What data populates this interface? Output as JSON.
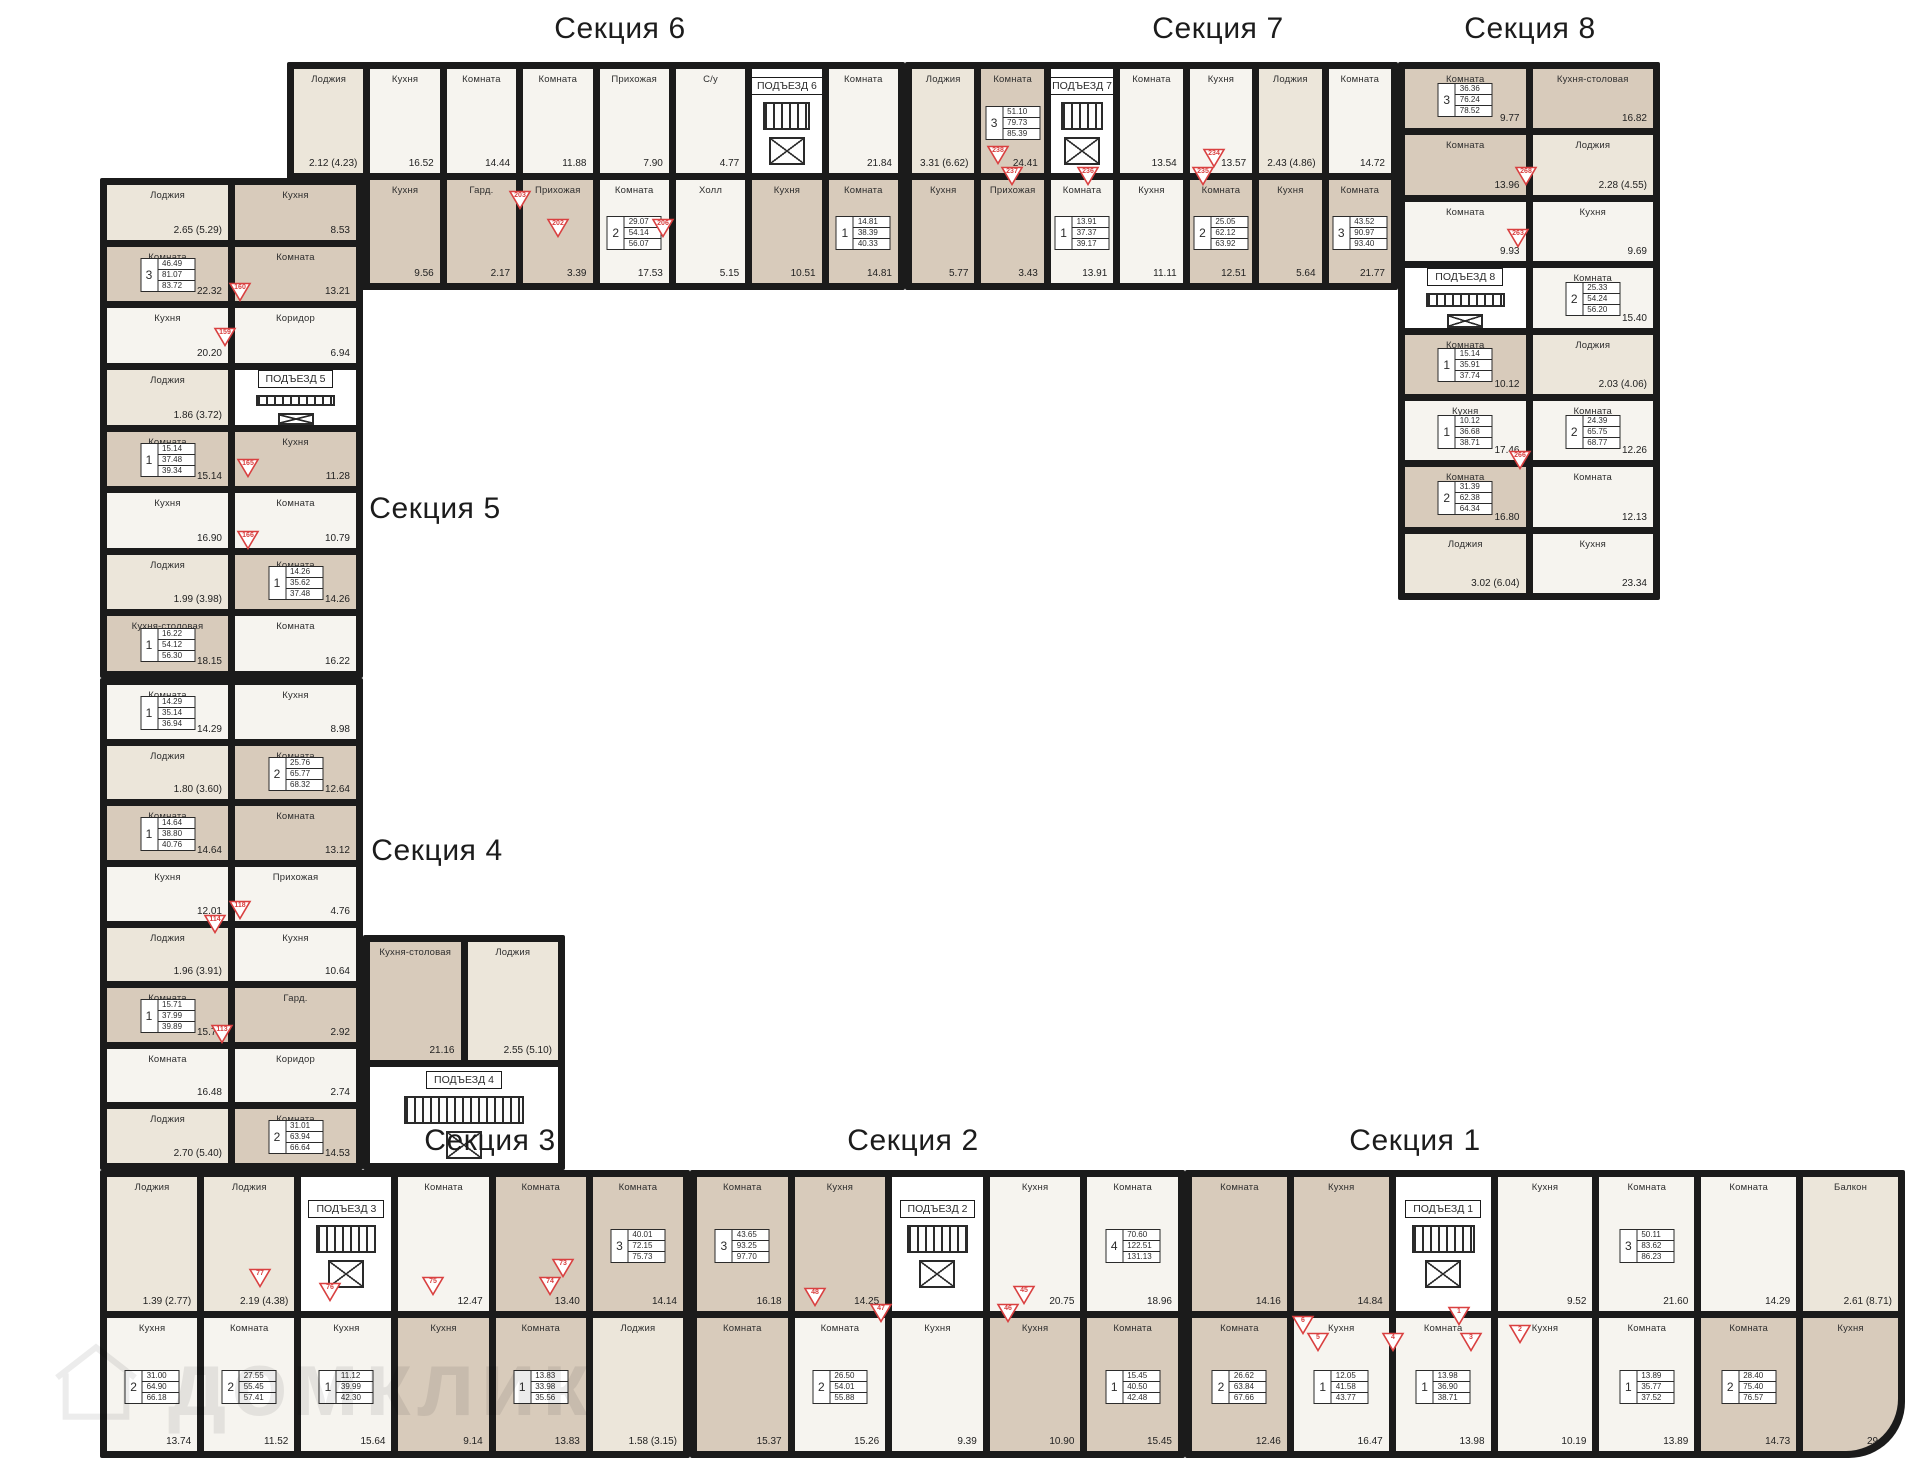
{
  "palette": {
    "wall": "#1b1b1b",
    "beige": "#d8cbbb",
    "white_room": "#f6f4ef",
    "loggia": "#ece6da",
    "accent_red": "#d94040"
  },
  "watermark": {
    "text": "домклик",
    "icon": "house-icon"
  },
  "sections": [
    {
      "id": "1",
      "title": "Секция 1",
      "tx": 1415,
      "ty": 1124
    },
    {
      "id": "2",
      "title": "Секция 2",
      "tx": 913,
      "ty": 1124
    },
    {
      "id": "3",
      "title": "Секция 3",
      "tx": 490,
      "ty": 1124
    },
    {
      "id": "4",
      "title": "Секция 4",
      "tx": 437,
      "ty": 834
    },
    {
      "id": "5",
      "title": "Секция 5",
      "tx": 435,
      "ty": 492
    },
    {
      "id": "6",
      "title": "Секция 6",
      "tx": 620,
      "ty": 12
    },
    {
      "id": "7",
      "title": "Секция 7",
      "tx": 1218,
      "ty": 12
    },
    {
      "id": "8",
      "title": "Секция 8",
      "tx": 1530,
      "ty": 12
    }
  ],
  "badges": [
    {
      "n": "203",
      "x": 520,
      "y": 200
    },
    {
      "n": "202",
      "x": 558,
      "y": 228
    },
    {
      "n": "206",
      "x": 663,
      "y": 228
    },
    {
      "n": "238",
      "x": 998,
      "y": 155
    },
    {
      "n": "237",
      "x": 1012,
      "y": 176
    },
    {
      "n": "236",
      "x": 1088,
      "y": 176
    },
    {
      "n": "235",
      "x": 1203,
      "y": 176
    },
    {
      "n": "234",
      "x": 1214,
      "y": 158
    },
    {
      "n": "268",
      "x": 1526,
      "y": 176
    },
    {
      "n": "263",
      "x": 1518,
      "y": 238
    },
    {
      "n": "266",
      "x": 1520,
      "y": 460
    },
    {
      "n": "160",
      "x": 240,
      "y": 292
    },
    {
      "n": "159",
      "x": 225,
      "y": 337
    },
    {
      "n": "165",
      "x": 248,
      "y": 468
    },
    {
      "n": "166",
      "x": 248,
      "y": 540
    },
    {
      "n": "118",
      "x": 240,
      "y": 910
    },
    {
      "n": "114",
      "x": 215,
      "y": 924
    },
    {
      "n": "113",
      "x": 222,
      "y": 1034
    },
    {
      "n": "77",
      "x": 260,
      "y": 1278
    },
    {
      "n": "76",
      "x": 330,
      "y": 1292
    },
    {
      "n": "75",
      "x": 433,
      "y": 1286
    },
    {
      "n": "74",
      "x": 550,
      "y": 1286
    },
    {
      "n": "73",
      "x": 563,
      "y": 1268
    },
    {
      "n": "48",
      "x": 815,
      "y": 1297
    },
    {
      "n": "47",
      "x": 881,
      "y": 1313
    },
    {
      "n": "46",
      "x": 1008,
      "y": 1313
    },
    {
      "n": "45",
      "x": 1024,
      "y": 1295
    },
    {
      "n": "6",
      "x": 1303,
      "y": 1325
    },
    {
      "n": "5",
      "x": 1318,
      "y": 1342
    },
    {
      "n": "4",
      "x": 1393,
      "y": 1342
    },
    {
      "n": "3",
      "x": 1471,
      "y": 1342
    },
    {
      "n": "2",
      "x": 1520,
      "y": 1334
    },
    {
      "n": "1",
      "x": 1459,
      "y": 1316
    }
  ],
  "wings": [
    {
      "name": "section6-band",
      "x": 287,
      "y": 62,
      "w": 618,
      "h": 228,
      "cols": 8,
      "cells": [
        {
          "r": "Лоджия",
          "a": "2.12 (4.23)",
          "v": "l"
        },
        {
          "r": "Кухня",
          "a": "16.52",
          "v": "w"
        },
        {
          "r": "Комната",
          "a": "14.44",
          "v": "w"
        },
        {
          "r": "Комната",
          "a": "11.88",
          "v": "w"
        },
        {
          "r": "Прихожая",
          "a": "7.90",
          "v": "w"
        },
        {
          "r": "С/у",
          "a": "4.77",
          "v": "w"
        },
        {
          "v": "core",
          "ent": "ПОДЪЕЗД 6"
        },
        {
          "r": "Комната",
          "a": "21.84",
          "v": "w"
        },
        {
          "r": "Комната",
          "a": "12.45",
          "v": "b",
          "apt": {
            "n": "3",
            "v1": "38.77",
            "v2": "84.77",
            "v3": "89.03"
          }
        },
        {
          "r": "Кухня",
          "a": "9.56",
          "v": "b"
        },
        {
          "r": "Гард.",
          "a": "2.17",
          "v": "b"
        },
        {
          "r": "Прихожая",
          "a": "3.39",
          "v": "b"
        },
        {
          "r": "Комната",
          "a": "17.53",
          "v": "w",
          "apt": {
            "n": "2",
            "v1": "29.07",
            "v2": "54.14",
            "v3": "56.07"
          }
        },
        {
          "r": "Холл",
          "a": "5.15",
          "v": "w"
        },
        {
          "r": "Кухня",
          "a": "10.51",
          "v": "b"
        },
        {
          "r": "Комната",
          "a": "14.81",
          "v": "b",
          "apt": {
            "n": "1",
            "v1": "14.81",
            "v2": "38.39",
            "v3": "40.33"
          }
        }
      ]
    },
    {
      "name": "section7-band",
      "x": 905,
      "y": 62,
      "w": 493,
      "h": 228,
      "cols": 7,
      "cells": [
        {
          "r": "Лоджия",
          "a": "3.31 (6.62)",
          "v": "l"
        },
        {
          "r": "Комната",
          "a": "24.41",
          "v": "b",
          "apt": {
            "n": "3",
            "v1": "51.10",
            "v2": "79.73",
            "v3": "85.39"
          }
        },
        {
          "v": "core",
          "ent": "ПОДЪЕЗД 7"
        },
        {
          "r": "Комната",
          "a": "13.54",
          "v": "w"
        },
        {
          "r": "Кухня",
          "a": "13.57",
          "v": "w"
        },
        {
          "r": "Лоджия",
          "a": "2.43 (4.86)",
          "v": "l"
        },
        {
          "r": "Комната",
          "a": "14.72",
          "v": "w"
        },
        {
          "r": "Кухня",
          "a": "5.77",
          "v": "b"
        },
        {
          "r": "Прихожая",
          "a": "3.43",
          "v": "b"
        },
        {
          "r": "Комната",
          "a": "13.91",
          "v": "w",
          "apt": {
            "n": "1",
            "v1": "13.91",
            "v2": "37.37",
            "v3": "39.17"
          }
        },
        {
          "r": "Кухня",
          "a": "11.11",
          "v": "w"
        },
        {
          "r": "Комната",
          "a": "12.51",
          "v": "b",
          "apt": {
            "n": "2",
            "v1": "25.05",
            "v2": "62.12",
            "v3": "63.92"
          }
        },
        {
          "r": "Кухня",
          "a": "5.64",
          "v": "b"
        },
        {
          "r": "Комната",
          "a": "21.77",
          "v": "b",
          "apt": {
            "n": "3",
            "v1": "43.52",
            "v2": "90.97",
            "v3": "93.40"
          }
        }
      ]
    },
    {
      "name": "section8-wing",
      "x": 1398,
      "y": 62,
      "w": 262,
      "h": 538,
      "cols": 2,
      "cells": [
        {
          "r": "Комната",
          "a": "9.77",
          "v": "b",
          "apt": {
            "n": "3",
            "v1": "36.36",
            "v2": "76.24",
            "v3": "78.52"
          }
        },
        {
          "r": "Кухня-столовая",
          "a": "16.82",
          "v": "b"
        },
        {
          "r": "Комната",
          "a": "13.96",
          "v": "b"
        },
        {
          "r": "Лоджия",
          "a": "2.28 (4.55)",
          "v": "l"
        },
        {
          "r": "Комната",
          "a": "9.93",
          "v": "w"
        },
        {
          "r": "Кухня",
          "a": "9.69",
          "v": "w"
        },
        {
          "v": "core",
          "ent": "ПОДЪЕЗД 8"
        },
        {
          "r": "Комната",
          "a": "15.40",
          "v": "w",
          "apt": {
            "n": "2",
            "v1": "25.33",
            "v2": "54.24",
            "v3": "56.20"
          }
        },
        {
          "r": "Комната",
          "a": "10.12",
          "v": "b",
          "apt": {
            "n": "1",
            "v1": "15.14",
            "v2": "35.91",
            "v3": "37.74"
          }
        },
        {
          "r": "Лоджия",
          "a": "2.03 (4.06)",
          "v": "l"
        },
        {
          "r": "Кухня",
          "a": "17.46",
          "v": "w",
          "apt": {
            "n": "1",
            "v1": "10.12",
            "v2": "36.68",
            "v3": "38.71"
          }
        },
        {
          "r": "Комната",
          "a": "12.26",
          "v": "w",
          "apt": {
            "n": "2",
            "v1": "24.39",
            "v2": "65.75",
            "v3": "68.77"
          }
        },
        {
          "r": "Комната",
          "a": "16.80",
          "v": "b",
          "apt": {
            "n": "2",
            "v1": "31.39",
            "v2": "62.38",
            "v3": "64.34"
          }
        },
        {
          "r": "Комната",
          "a": "12.13",
          "v": "w"
        },
        {
          "r": "Лоджия",
          "a": "3.02 (6.04)",
          "v": "l"
        },
        {
          "r": "Кухня",
          "a": "23.34",
          "v": "w"
        }
      ]
    },
    {
      "name": "section5-wing",
      "x": 100,
      "y": 178,
      "w": 263,
      "h": 500,
      "cols": 2,
      "cells": [
        {
          "r": "Лоджия",
          "a": "2.65 (5.29)",
          "v": "l"
        },
        {
          "r": "Кухня",
          "a": "8.53",
          "v": "b"
        },
        {
          "r": "Комната",
          "a": "22.32",
          "v": "b",
          "apt": {
            "n": "3",
            "v1": "46.49",
            "v2": "81.07",
            "v3": "83.72"
          }
        },
        {
          "r": "Комната",
          "a": "13.21",
          "v": "b"
        },
        {
          "r": "Кухня",
          "a": "20.20",
          "v": "w"
        },
        {
          "r": "Коридор",
          "a": "6.94",
          "v": "w"
        },
        {
          "r": "Лоджия",
          "a": "1.86 (3.72)",
          "v": "l"
        },
        {
          "v": "core",
          "ent": "ПОДЪЕЗД 5"
        },
        {
          "r": "Комната",
          "a": "15.14",
          "v": "b",
          "apt": {
            "n": "1",
            "v1": "15.14",
            "v2": "37.48",
            "v3": "39.34"
          }
        },
        {
          "r": "Кухня",
          "a": "11.28",
          "v": "b"
        },
        {
          "r": "Кухня",
          "a": "16.90",
          "v": "w"
        },
        {
          "r": "Комната",
          "a": "10.79",
          "v": "w"
        },
        {
          "r": "Лоджия",
          "a": "1.99 (3.98)",
          "v": "l"
        },
        {
          "r": "Комната",
          "a": "14.26",
          "v": "b",
          "apt": {
            "n": "1",
            "v1": "14.26",
            "v2": "35.62",
            "v3": "37.48"
          }
        },
        {
          "r": "Кухня-столовая",
          "a": "18.15",
          "v": "b",
          "apt": {
            "n": "1",
            "v1": "16.22",
            "v2": "54.12",
            "v3": "56.30"
          }
        },
        {
          "r": "Комната",
          "a": "16.22",
          "v": "w"
        }
      ]
    },
    {
      "name": "section4-wing",
      "x": 100,
      "y": 678,
      "w": 263,
      "h": 492,
      "cols": 2,
      "cells": [
        {
          "r": "Комната",
          "a": "14.29",
          "v": "w",
          "apt": {
            "n": "1",
            "v1": "14.29",
            "v2": "35.14",
            "v3": "36.94"
          }
        },
        {
          "r": "Кухня",
          "a": "8.98",
          "v": "w"
        },
        {
          "r": "Лоджия",
          "a": "1.80 (3.60)",
          "v": "l"
        },
        {
          "r": "Комната",
          "a": "12.64",
          "v": "b",
          "apt": {
            "n": "2",
            "v1": "25.76",
            "v2": "65.77",
            "v3": "68.32"
          }
        },
        {
          "r": "Комната",
          "a": "14.64",
          "v": "b",
          "apt": {
            "n": "1",
            "v1": "14.64",
            "v2": "38.80",
            "v3": "40.76"
          }
        },
        {
          "r": "Комната",
          "a": "13.12",
          "v": "b"
        },
        {
          "r": "Кухня",
          "a": "12.01",
          "v": "w"
        },
        {
          "r": "Прихожая",
          "a": "4.76",
          "v": "w"
        },
        {
          "r": "Лоджия",
          "a": "1.96 (3.91)",
          "v": "l"
        },
        {
          "r": "Кухня",
          "a": "10.64",
          "v": "w"
        },
        {
          "r": "Комната",
          "a": "15.71",
          "v": "b",
          "apt": {
            "n": "1",
            "v1": "15.71",
            "v2": "37.99",
            "v3": "39.89"
          }
        },
        {
          "r": "Гард.",
          "a": "2.92",
          "v": "b"
        },
        {
          "r": "Комната",
          "a": "16.48",
          "v": "w"
        },
        {
          "r": "Коридор",
          "a": "2.74",
          "v": "w"
        },
        {
          "r": "Лоджия",
          "a": "2.70 (5.40)",
          "v": "l"
        },
        {
          "r": "Комната",
          "a": "14.53",
          "v": "b",
          "apt": {
            "n": "2",
            "v1": "31.01",
            "v2": "63.94",
            "v3": "66.64"
          }
        }
      ]
    },
    {
      "name": "section4-inner-block",
      "x": 363,
      "y": 935,
      "w": 202,
      "h": 235,
      "cols": 2,
      "rowsTpl": "118px 1fr",
      "cells": [
        {
          "r": "Кухня-столовая",
          "a": "21.16",
          "v": "b"
        },
        {
          "r": "Лоджия",
          "a": "2.55 (5.10)",
          "v": "l"
        },
        {
          "v": "core",
          "ent": "ПОДЪЕЗД 4",
          "colspan": 2
        }
      ]
    },
    {
      "name": "section3-band",
      "x": 100,
      "y": 1170,
      "w": 590,
      "h": 288,
      "cols": 6,
      "cells": [
        {
          "r": "Лоджия",
          "a": "1.39 (2.77)",
          "v": "l"
        },
        {
          "r": "Лоджия",
          "a": "2.19 (4.38)",
          "v": "l"
        },
        {
          "v": "core",
          "ent": "ПОДЪЕЗД 3"
        },
        {
          "r": "Комната",
          "a": "12.47",
          "v": "w"
        },
        {
          "r": "Комната",
          "a": "13.40",
          "v": "b"
        },
        {
          "r": "Комната",
          "a": "14.14",
          "v": "b",
          "apt": {
            "n": "3",
            "v1": "40.01",
            "v2": "72.15",
            "v3": "75.73"
          }
        },
        {
          "r": "Кухня",
          "a": "13.74",
          "v": "w",
          "apt": {
            "n": "2",
            "v1": "31.00",
            "v2": "64.90",
            "v3": "66.18"
          }
        },
        {
          "r": "Комната",
          "a": "11.52",
          "v": "w",
          "apt": {
            "n": "2",
            "v1": "27.55",
            "v2": "55.45",
            "v3": "57.41"
          }
        },
        {
          "r": "Кухня",
          "a": "15.64",
          "v": "w",
          "apt": {
            "n": "1",
            "v1": "11.12",
            "v2": "39.99",
            "v3": "42.30"
          }
        },
        {
          "r": "Кухня",
          "a": "9.14",
          "v": "b"
        },
        {
          "r": "Комната",
          "a": "13.83",
          "v": "b",
          "apt": {
            "n": "1",
            "v1": "13.83",
            "v2": "33.98",
            "v3": "35.56"
          }
        },
        {
          "r": "Лоджия",
          "a": "1.58 (3.15)",
          "v": "l"
        }
      ]
    },
    {
      "name": "section2-band",
      "x": 690,
      "y": 1170,
      "w": 495,
      "h": 288,
      "cols": 5,
      "cells": [
        {
          "r": "Комната",
          "a": "16.18",
          "v": "b",
          "apt": {
            "n": "3",
            "v1": "43.65",
            "v2": "93.25",
            "v3": "97.70"
          }
        },
        {
          "r": "Кухня",
          "a": "14.25",
          "v": "b"
        },
        {
          "v": "core",
          "ent": "ПОДЪЕЗД 2"
        },
        {
          "r": "Кухня",
          "a": "20.75",
          "v": "w"
        },
        {
          "r": "Комната",
          "a": "18.96",
          "v": "w",
          "apt": {
            "n": "4",
            "v1": "70.60",
            "v2": "122.51",
            "v3": "131.13"
          }
        },
        {
          "r": "Комната",
          "a": "15.37",
          "v": "b"
        },
        {
          "r": "Комната",
          "a": "15.26",
          "v": "w",
          "apt": {
            "n": "2",
            "v1": "26.50",
            "v2": "54.01",
            "v3": "55.88"
          }
        },
        {
          "r": "Кухня",
          "a": "9.39",
          "v": "w"
        },
        {
          "r": "Кухня",
          "a": "10.90",
          "v": "b"
        },
        {
          "r": "Комната",
          "a": "15.45",
          "v": "b",
          "apt": {
            "n": "1",
            "v1": "15.45",
            "v2": "40.50",
            "v3": "42.48"
          }
        }
      ]
    },
    {
      "name": "section1-band",
      "x": 1185,
      "y": 1170,
      "w": 720,
      "h": 288,
      "cols": 7,
      "br": 56,
      "cells": [
        {
          "r": "Комната",
          "a": "14.16",
          "v": "b"
        },
        {
          "r": "Кухня",
          "a": "14.84",
          "v": "b"
        },
        {
          "v": "core",
          "ent": "ПОДЪЕЗД 1"
        },
        {
          "r": "Кухня",
          "a": "9.52",
          "v": "w"
        },
        {
          "r": "Комната",
          "a": "21.60",
          "v": "w",
          "apt": {
            "n": "3",
            "v1": "50.11",
            "v2": "83.62",
            "v3": "86.23"
          }
        },
        {
          "r": "Комната",
          "a": "14.29",
          "v": "w"
        },
        {
          "r": "Балкон",
          "a": "2.61 (8.71)",
          "v": "l"
        },
        {
          "r": "Комната",
          "a": "12.46",
          "v": "b",
          "apt": {
            "n": "2",
            "v1": "26.62",
            "v2": "63.84",
            "v3": "67.66"
          }
        },
        {
          "r": "Кухня",
          "a": "16.47",
          "v": "w",
          "apt": {
            "n": "1",
            "v1": "12.05",
            "v2": "41.58",
            "v3": "43.77"
          }
        },
        {
          "r": "Комната",
          "a": "13.98",
          "v": "w",
          "apt": {
            "n": "1",
            "v1": "13.98",
            "v2": "36.90",
            "v3": "38.71"
          }
        },
        {
          "r": "Кухня",
          "a": "10.19",
          "v": "w"
        },
        {
          "r": "Комната",
          "a": "13.89",
          "v": "w",
          "apt": {
            "n": "1",
            "v1": "13.89",
            "v2": "35.77",
            "v3": "37.52"
          }
        },
        {
          "r": "Комната",
          "a": "14.73",
          "v": "b",
          "apt": {
            "n": "2",
            "v1": "28.40",
            "v2": "75.40",
            "v3": "76.57"
          }
        },
        {
          "r": "Кухня",
          "a": "29.50",
          "v": "b",
          "round": true
        }
      ]
    }
  ]
}
